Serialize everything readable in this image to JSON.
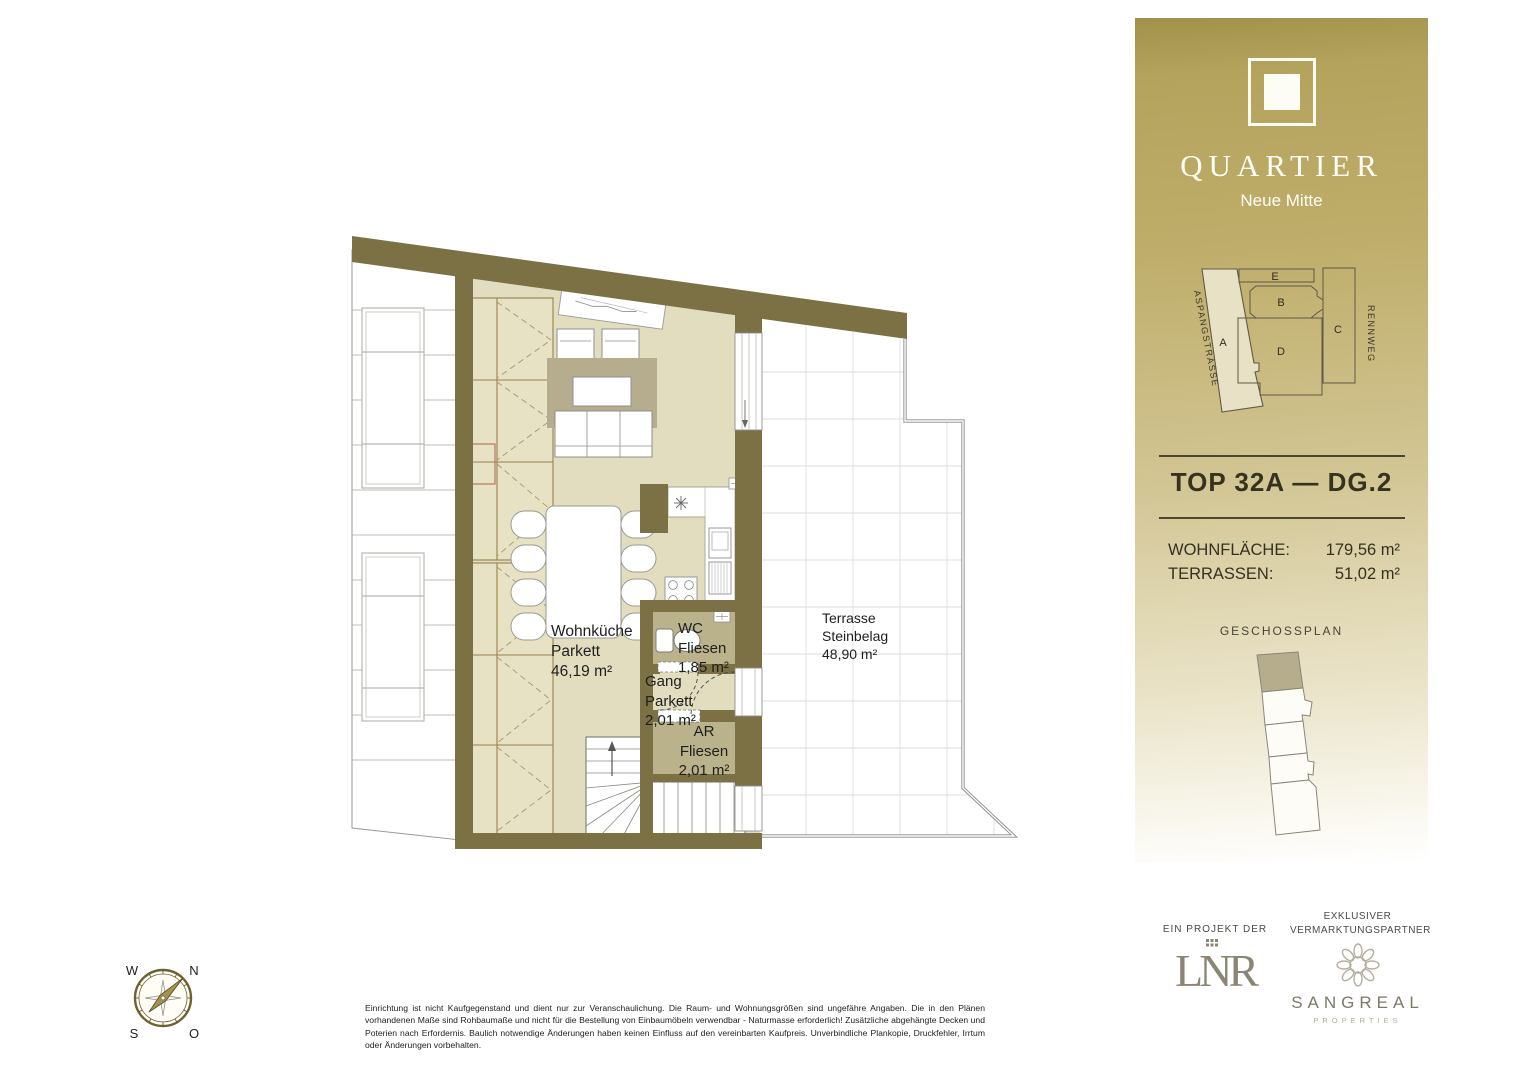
{
  "colors": {
    "wall": "#7c7045",
    "room_fill": "#e2ddbf",
    "wet_room_fill": "#b9b28a",
    "rug": "#b5ad8e",
    "sidebar_gold": "#b4a35d",
    "brand_text": "#fffef8",
    "site_building_fill": "#e9e1c6"
  },
  "plan": {
    "rooms": {
      "wohnkueche": "Wohnküche\nParkett\n46,19 m²",
      "wc": "WC\nFliesen\n1,85 m²",
      "gang": "Gang\nParkett\n2,01 m²",
      "ar": "AR\nFliesen\n2,01 m²",
      "terrasse": "Terrasse\nSteinbelag\n48,90 m²"
    },
    "compass": {
      "w": "W",
      "n": "N",
      "s": "S",
      "o": "O"
    }
  },
  "sidebar": {
    "brand_title": "QUARTIER",
    "brand_subtitle": "Neue Mitte",
    "siteplan": {
      "street_left": "ASPANGSTRASSE",
      "street_right": "RENNWEG",
      "buildings": [
        "A",
        "B",
        "C",
        "D",
        "E"
      ]
    },
    "unit_title": "TOP 32A — DG.2",
    "areas": [
      {
        "label": "WOHNFLÄCHE:",
        "value": "179,56 m²"
      },
      {
        "label": "TERRASSEN:",
        "value": "51,02 m²"
      }
    ],
    "plan_caption": "GESCHOSSPLAN"
  },
  "footer": {
    "disclaimer": "Einrichtung ist nicht Kaufgegenstand und dient nur zur Veranschaulichung. Die Raum- und Wohnungsgrößen sind ungefähre Angaben. Die in den Plänen vorhandenen Maße sind Rohbaumaße und nicht für die Bestellung von Einbaumöbeln verwendbar - Naturmasse erforderlich! Zusätzliche abgehängte Decken und Poterien nach Erfordernis. Baulich notwendige Änderungen haben keinen Einfluss auf den vereinbarten Kaufpreis. Unverbindliche Plankopie, Druckfehler, Irrtum oder Änderungen vorbehalten.",
    "project_caption": "EIN PROJEKT DER",
    "project_logo": "LNR",
    "partner_caption": "EXKLUSIVER\nVERMARKTUNGSPARTNER",
    "partner_logo": "SANGREAL",
    "partner_logo_sub": "PROPERTIES"
  }
}
